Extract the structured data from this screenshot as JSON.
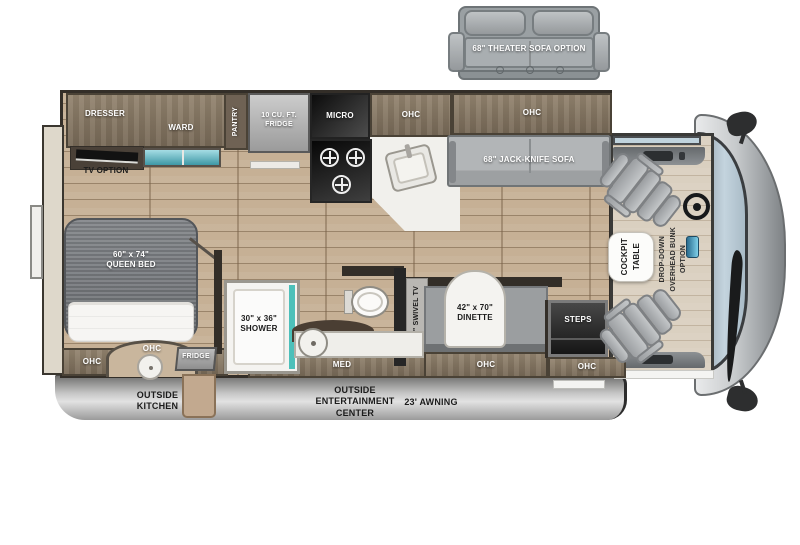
{
  "theater_sofa": {
    "label": "68\" THEATER SOFA OPTION"
  },
  "bedroom": {
    "dresser": "DRESSER",
    "ward": "WARD",
    "pantry": "PANTRY",
    "tv_option": "TV OPTION",
    "bed": "60\" x 74\"\nQUEEN BED",
    "ohc": "OHC"
  },
  "outside_kitchen": {
    "ohc": "OHC",
    "fridge": "FRIDGE"
  },
  "kitchen": {
    "fridge": "10 CU. FT.\nFRIDGE",
    "micro": "MICRO",
    "ohc": "OHC"
  },
  "living": {
    "ohc": "OHC",
    "jack_knife_sofa": "68\" JACK-KNIFE SOFA",
    "swivel_tv": "39\" SWIVEL TV",
    "dinette": "42\" x 70\"\nDINETTE",
    "dinette_ohc": "OHC",
    "steps": "STEPS",
    "entry_ohc": "OHC"
  },
  "bathroom": {
    "shower": "30\" x 36\"\nSHOWER",
    "med": "MED"
  },
  "cockpit": {
    "table_line1": "COCKPIT",
    "table_line2": "TABLE",
    "bunk_line1": "DROP-DOWN",
    "bunk_line2": "OVERHEAD BUNK",
    "bunk_line3": "OPTION"
  },
  "exterior": {
    "outside_kitchen": "OUTSIDE\nKITCHEN",
    "outside_entertainment": "OUTSIDE\nENTERTAINMENT\nCENTER",
    "awning": "23' AWNING"
  },
  "colors": {
    "floor_wood": "#c6b095",
    "cabinet_brown": "#84755f",
    "wall_dark": "#332e28",
    "upholstery_gray": "#a7aaac",
    "counter_white": "#f2f1ed",
    "shower_glass": "#4cc0ba",
    "drawer_teal": "#5fb7c4",
    "windshield_blue": "#bdd0db",
    "skirt_gray": "#b5b5b5",
    "cockpit_floor": "#dad0c0"
  }
}
